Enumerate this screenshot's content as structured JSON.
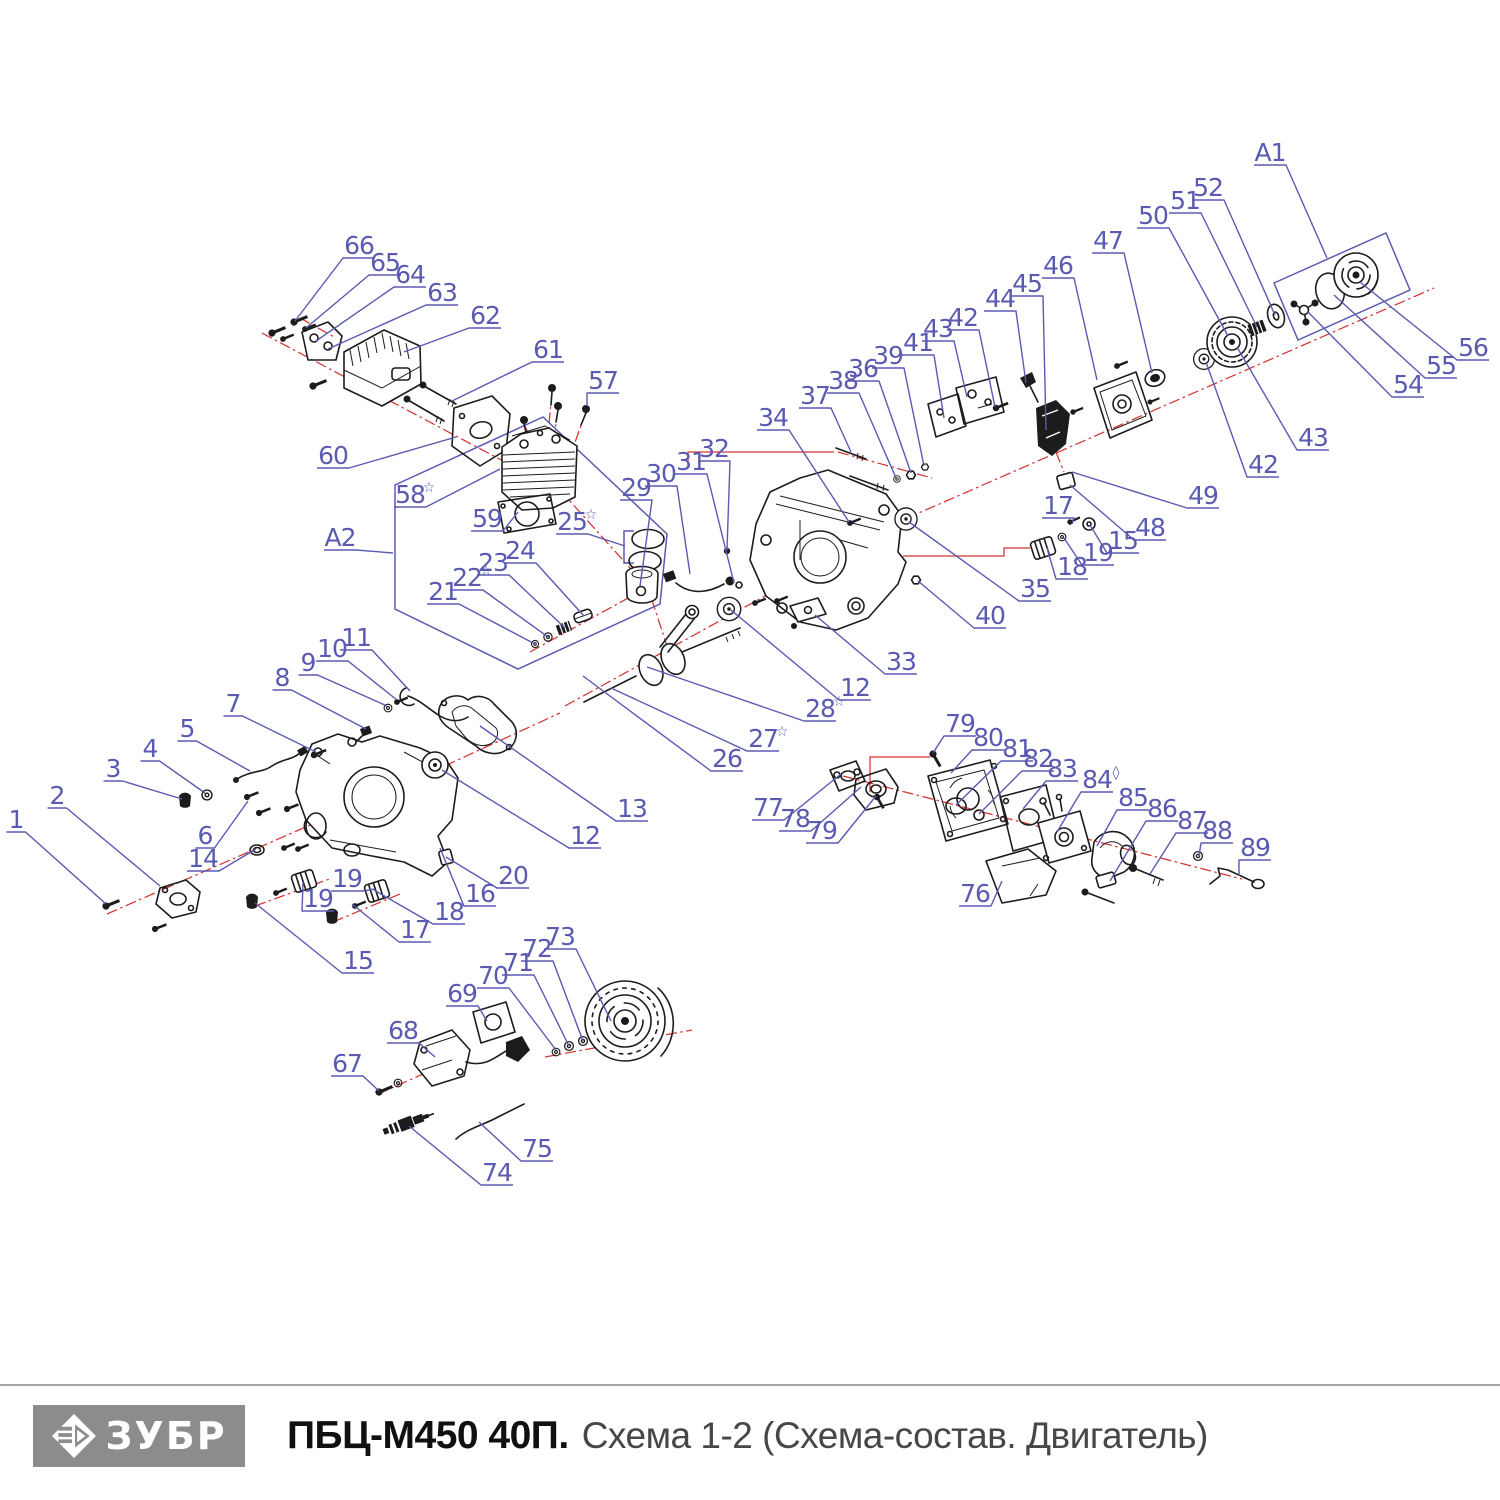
{
  "colors": {
    "callout": "#5a5ab2",
    "ink": "#1c1c1c",
    "red": "#d63434",
    "bar": "#8c8c8c",
    "title": "#101010",
    "sub": "#474747",
    "rule": "#a6a6a6",
    "background": "#ffffff"
  },
  "footer": {
    "brand": "ЗУБР",
    "title_bold": "ПБЦ-М450 40П.",
    "title_rest": "Схема 1-2 (Схема-состав. Двигатель)"
  },
  "diagram": {
    "callouts": [
      {
        "t": "1",
        "x": 16,
        "y": 819,
        "ex": 106,
        "ey": 904
      },
      {
        "t": "2",
        "x": 57,
        "y": 795,
        "ex": 160,
        "ey": 886
      },
      {
        "t": "3",
        "x": 113,
        "y": 768,
        "ex": 182,
        "ey": 799
      },
      {
        "t": "4",
        "x": 150,
        "y": 748,
        "ex": 205,
        "ey": 793
      },
      {
        "t": "5",
        "x": 187,
        "y": 728,
        "ex": 250,
        "ey": 771
      },
      {
        "t": "6",
        "x": 205,
        "y": 835,
        "ex": 248,
        "ey": 801
      },
      {
        "t": "7",
        "x": 233,
        "y": 703,
        "ex": 316,
        "ey": 752
      },
      {
        "t": "8",
        "x": 282,
        "y": 677,
        "ex": 366,
        "ey": 729
      },
      {
        "t": "9",
        "x": 308,
        "y": 662,
        "ex": 387,
        "ey": 706
      },
      {
        "t": "10",
        "x": 332,
        "y": 648,
        "ex": 397,
        "ey": 700
      },
      {
        "t": "11",
        "x": 356,
        "y": 637,
        "ex": 410,
        "ey": 691
      },
      {
        "t": "12",
        "x": 585,
        "y": 835,
        "ex": 442,
        "ey": 770
      },
      {
        "t": "12",
        "x": 855,
        "y": 687,
        "ex": 731,
        "ey": 610
      },
      {
        "t": "13",
        "x": 632,
        "y": 808,
        "ex": 480,
        "ey": 726
      },
      {
        "t": "14",
        "x": 203,
        "y": 858,
        "ex": 256,
        "ey": 849
      },
      {
        "t": "15",
        "x": 358,
        "y": 960,
        "ex": 255,
        "ey": 903
      },
      {
        "t": "15",
        "x": 1123,
        "y": 540,
        "ex": 1090,
        "ey": 525
      },
      {
        "t": "16",
        "x": 480,
        "y": 893,
        "ex": 440,
        "ey": 848
      },
      {
        "t": "17",
        "x": 415,
        "y": 929,
        "ex": 352,
        "ey": 904
      },
      {
        "t": "17",
        "x": 1058,
        "y": 505,
        "ex": 1072,
        "ey": 524
      },
      {
        "t": "18",
        "x": 449,
        "y": 911,
        "ex": 374,
        "ey": 890
      },
      {
        "t": "18",
        "x": 1072,
        "y": 566,
        "ex": 1047,
        "ey": 548
      },
      {
        "t": "19",
        "x": 318,
        "y": 898,
        "ex": 303,
        "ey": 882
      },
      {
        "t": "19",
        "x": 347,
        "y": 878,
        "ex": 375,
        "ey": 889
      },
      {
        "t": "19",
        "x": 1098,
        "y": 552,
        "ex": 1064,
        "ey": 538
      },
      {
        "t": "20",
        "x": 513,
        "y": 875,
        "ex": 446,
        "ey": 857
      },
      {
        "t": "21",
        "x": 443,
        "y": 591,
        "ex": 535,
        "ey": 644
      },
      {
        "t": "22",
        "s": "☆",
        "x": 467,
        "y": 577,
        "ex": 548,
        "ey": 637
      },
      {
        "t": "23",
        "x": 493,
        "y": 562,
        "ex": 565,
        "ey": 628
      },
      {
        "t": "24",
        "x": 520,
        "y": 550,
        "ex": 584,
        "ey": 616
      },
      {
        "t": "25",
        "s": "☆",
        "x": 572,
        "y": 521,
        "ex": 625,
        "ey": 546
      },
      {
        "t": "26",
        "x": 727,
        "y": 758,
        "ex": 583,
        "ey": 676
      },
      {
        "t": "27",
        "s": "☆",
        "x": 763,
        "y": 738,
        "ex": 611,
        "ey": 688
      },
      {
        "t": "28",
        "s": "☆",
        "x": 820,
        "y": 708,
        "ex": 647,
        "ey": 667
      },
      {
        "t": "29",
        "x": 636,
        "y": 487,
        "ex": 640,
        "ey": 586
      },
      {
        "t": "30",
        "x": 661,
        "y": 473,
        "ex": 690,
        "ey": 574
      },
      {
        "t": "31",
        "x": 691,
        "y": 461,
        "ex": 734,
        "ey": 583
      },
      {
        "t": "32",
        "x": 714,
        "y": 448,
        "ex": 727,
        "ey": 550
      },
      {
        "t": "33",
        "x": 901,
        "y": 661,
        "ex": 815,
        "ey": 615
      },
      {
        "t": "34",
        "x": 773,
        "y": 417,
        "ex": 849,
        "ey": 522
      },
      {
        "t": "35",
        "x": 1035,
        "y": 588,
        "ex": 909,
        "ey": 522
      },
      {
        "t": "36",
        "x": 863,
        "y": 368,
        "ex": 911,
        "ey": 473
      },
      {
        "t": "37",
        "x": 815,
        "y": 395,
        "ex": 851,
        "ey": 452
      },
      {
        "t": "38",
        "x": 843,
        "y": 380,
        "ex": 896,
        "ey": 478
      },
      {
        "t": "39",
        "x": 888,
        "y": 355,
        "ex": 924,
        "ey": 466
      },
      {
        "t": "40",
        "x": 990,
        "y": 615,
        "ex": 918,
        "ey": 581
      },
      {
        "t": "41",
        "x": 918,
        "y": 342,
        "ex": 944,
        "ey": 418
      },
      {
        "t": "42",
        "x": 963,
        "y": 317,
        "ex": 995,
        "ey": 407
      },
      {
        "t": "42",
        "x": 1263,
        "y": 464,
        "ex": 1206,
        "ey": 362
      },
      {
        "t": "43",
        "x": 938,
        "y": 328,
        "ex": 967,
        "ey": 397
      },
      {
        "t": "43",
        "x": 1313,
        "y": 437,
        "ex": 1237,
        "ey": 347
      },
      {
        "t": "44",
        "x": 1000,
        "y": 298,
        "ex": 1026,
        "ey": 383
      },
      {
        "t": "45",
        "x": 1027,
        "y": 283,
        "ex": 1046,
        "ey": 430
      },
      {
        "t": "46",
        "x": 1058,
        "y": 265,
        "ex": 1097,
        "ey": 380
      },
      {
        "t": "47",
        "x": 1108,
        "y": 240,
        "ex": 1152,
        "ey": 373
      },
      {
        "t": "48",
        "x": 1150,
        "y": 527,
        "ex": 1070,
        "ey": 485
      },
      {
        "t": "49",
        "x": 1203,
        "y": 495,
        "ex": 1072,
        "ey": 472
      },
      {
        "t": "50",
        "x": 1153,
        "y": 215,
        "ex": 1228,
        "ey": 336
      },
      {
        "t": "51",
        "x": 1185,
        "y": 200,
        "ex": 1257,
        "ey": 327
      },
      {
        "t": "52",
        "x": 1208,
        "y": 187,
        "ex": 1275,
        "ey": 315
      },
      {
        "t": "54",
        "x": 1408,
        "y": 384,
        "ex": 1308,
        "ey": 312
      },
      {
        "t": "55",
        "x": 1441,
        "y": 365,
        "ex": 1334,
        "ey": 295
      },
      {
        "t": "56",
        "x": 1473,
        "y": 347,
        "ex": 1360,
        "ey": 282
      },
      {
        "t": "57",
        "x": 603,
        "y": 380,
        "ex": 587,
        "ey": 406
      },
      {
        "t": "58",
        "s": "☆",
        "x": 410,
        "y": 494,
        "ex": 500,
        "ey": 469
      },
      {
        "t": "59",
        "x": 487,
        "y": 518,
        "ex": 518,
        "ey": 512
      },
      {
        "t": "60",
        "x": 333,
        "y": 455,
        "ex": 456,
        "ey": 437
      },
      {
        "t": "61",
        "x": 548,
        "y": 349,
        "ex": 452,
        "ey": 401
      },
      {
        "t": "62",
        "x": 485,
        "y": 315,
        "ex": 404,
        "ey": 352
      },
      {
        "t": "63",
        "x": 442,
        "y": 292,
        "ex": 328,
        "ey": 349
      },
      {
        "t": "64",
        "x": 410,
        "y": 274,
        "ex": 316,
        "ey": 341
      },
      {
        "t": "65",
        "x": 385,
        "y": 262,
        "ex": 306,
        "ey": 328
      },
      {
        "t": "66",
        "x": 359,
        "y": 245,
        "ex": 295,
        "ey": 321
      },
      {
        "t": "67",
        "x": 347,
        "y": 1063,
        "ex": 379,
        "ey": 1091
      },
      {
        "t": "68",
        "x": 403,
        "y": 1030,
        "ex": 435,
        "ey": 1057
      },
      {
        "t": "69",
        "x": 462,
        "y": 993,
        "ex": 487,
        "ey": 1021
      },
      {
        "t": "70",
        "x": 493,
        "y": 975,
        "ex": 556,
        "ey": 1050
      },
      {
        "t": "71",
        "x": 518,
        "y": 962,
        "ex": 569,
        "ey": 1046
      },
      {
        "t": "72",
        "x": 537,
        "y": 948,
        "ex": 583,
        "ey": 1041
      },
      {
        "t": "73",
        "x": 560,
        "y": 936,
        "ex": 611,
        "ey": 1021
      },
      {
        "t": "74",
        "x": 497,
        "y": 1172,
        "ex": 409,
        "ey": 1126
      },
      {
        "t": "75",
        "x": 537,
        "y": 1148,
        "ex": 479,
        "ey": 1122
      },
      {
        "t": "76",
        "x": 975,
        "y": 893,
        "ex": 1002,
        "ey": 881
      },
      {
        "t": "77",
        "x": 768,
        "y": 807,
        "ex": 841,
        "ey": 774
      },
      {
        "t": "78",
        "x": 795,
        "y": 818,
        "ex": 861,
        "ey": 787
      },
      {
        "t": "79",
        "x": 960,
        "y": 723,
        "ex": 933,
        "ey": 753
      },
      {
        "t": "79",
        "x": 822,
        "y": 830,
        "ex": 876,
        "ey": 796
      },
      {
        "t": "80",
        "x": 988,
        "y": 737,
        "ex": 951,
        "ey": 773
      },
      {
        "t": "81",
        "x": 1017,
        "y": 748,
        "ex": 956,
        "ey": 805
      },
      {
        "t": "82",
        "x": 1038,
        "y": 758,
        "ex": 979,
        "ey": 814
      },
      {
        "t": "83",
        "x": 1062,
        "y": 768,
        "ex": 1023,
        "ey": 809
      },
      {
        "t": "84",
        "s": "◊",
        "x": 1097,
        "y": 779,
        "ex": 1057,
        "ey": 832
      },
      {
        "t": "85",
        "x": 1133,
        "y": 797,
        "ex": 1097,
        "ey": 846
      },
      {
        "t": "86",
        "x": 1162,
        "y": 808,
        "ex": 1110,
        "ey": 881
      },
      {
        "t": "87",
        "x": 1192,
        "y": 820,
        "ex": 1150,
        "ey": 874
      },
      {
        "t": "88",
        "x": 1217,
        "y": 830,
        "ex": 1199,
        "ey": 856
      },
      {
        "t": "89",
        "x": 1255,
        "y": 847,
        "ex": 1239,
        "ey": 876
      },
      {
        "t": "A1",
        "x": 1270,
        "y": 152,
        "ex": 1327,
        "ey": 258
      },
      {
        "t": "A2",
        "x": 340,
        "y": 537,
        "ex": 393,
        "ey": 553
      }
    ]
  }
}
